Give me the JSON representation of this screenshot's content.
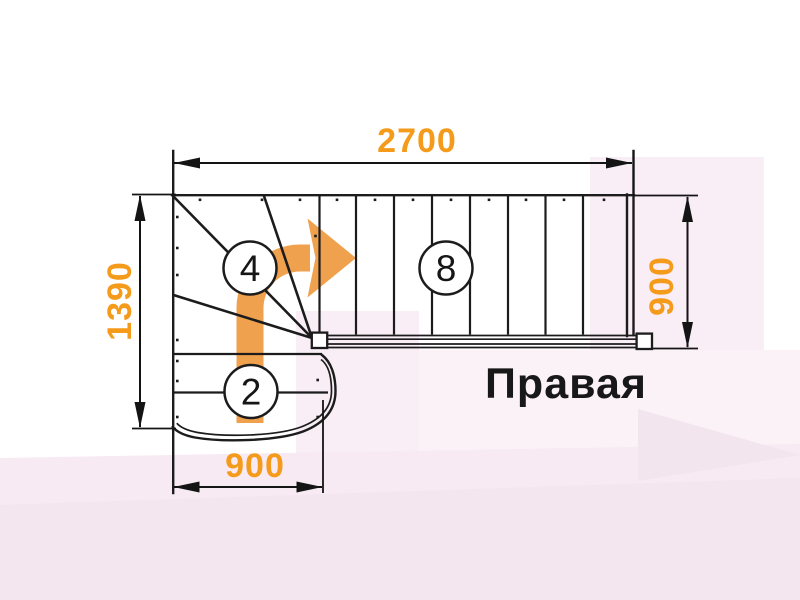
{
  "diagram": {
    "orientation_label": "Правая",
    "dims": {
      "top": "2700",
      "left": "1390",
      "right": "900",
      "bottom": "900"
    },
    "steps": {
      "winder_count": "4",
      "upper_flight_count": "8",
      "lower_flight_count": "2"
    },
    "colors": {
      "dimension_orange": "#F59B1C",
      "arrow_orange": "#F0A14D",
      "line_black": "#1C1C1C",
      "background_pink": "#F9EDF6"
    }
  }
}
